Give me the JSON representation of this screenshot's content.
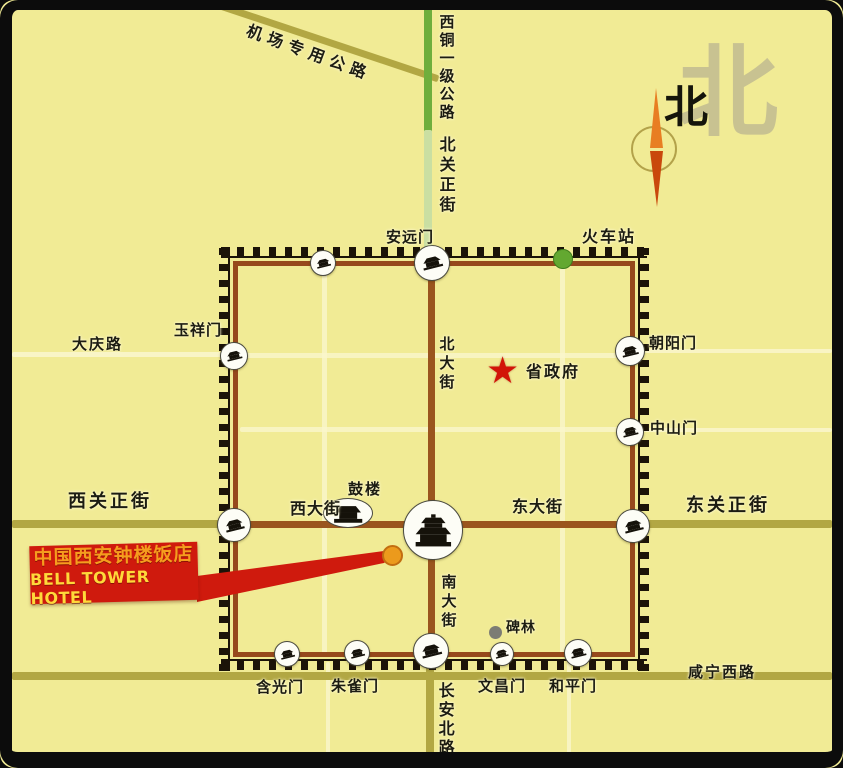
{
  "title": "Bell Tower Hotel Xi'an location map",
  "hotel": {
    "line1": "中国西安钟楼饭店",
    "line2": "BELL TOWER HOTEL"
  },
  "colors": {
    "background": "#f1eb95",
    "frame": "#0c0c0c",
    "wall": "#96491c",
    "teeth": "#1b1308",
    "street_brown": "#9a551e",
    "road_olive": "#b2a743",
    "road_white": "#faf6cc",
    "highway_green": "#6fae3c",
    "highway_pale": "#cadfa2",
    "banner_red": "#cf1a0d",
    "star_red": "#d21408",
    "station_green": "#63a830",
    "beilin_gray": "#7c7c74",
    "hotel_orange": "#ec9a1c",
    "compass_big": "#c8c291",
    "needle_orange": "#e87e22",
    "needle_dark": "#c9480c"
  },
  "compass": {
    "big": "北",
    "small": "北"
  },
  "labels": [
    {
      "name": "airport-road-label",
      "text": "机场专用公路",
      "x": 250,
      "y": 22,
      "size": 16,
      "spacing": 6,
      "rotate": 20,
      "mode": "h"
    },
    {
      "name": "xitong-highway-label",
      "text": "西铜一级公路",
      "x": 438,
      "y": 14,
      "size": 15,
      "spacing": 3,
      "mode": "v"
    },
    {
      "name": "beiguan-street-label",
      "text": "北关正街",
      "x": 437,
      "y": 136,
      "size": 16,
      "spacing": 4,
      "mode": "v"
    },
    {
      "name": "north-big-label",
      "text": "北",
      "x": 678,
      "y": 38,
      "size": 100,
      "spacing": 0,
      "mode": "h",
      "color": "#c8c291"
    },
    {
      "name": "north-small-label",
      "text": "北",
      "x": 664,
      "y": 84,
      "size": 44,
      "spacing": 0,
      "mode": "h",
      "color": "#15150b"
    },
    {
      "name": "station-label",
      "text": "火车站",
      "x": 582,
      "y": 228,
      "size": 16,
      "spacing": 2,
      "mode": "h"
    },
    {
      "name": "anyuanmen-label",
      "text": "安远门",
      "x": 386,
      "y": 229,
      "size": 15,
      "spacing": 1,
      "mode": "h"
    },
    {
      "name": "daqing-road-label",
      "text": "大庆路",
      "x": 72,
      "y": 336,
      "size": 15,
      "spacing": 2,
      "mode": "h"
    },
    {
      "name": "yuxiangmen-label",
      "text": "玉祥门",
      "x": 174,
      "y": 322,
      "size": 15,
      "spacing": 1,
      "mode": "h"
    },
    {
      "name": "chaoyangmen-label",
      "text": "朝阳门",
      "x": 649,
      "y": 335,
      "size": 15,
      "spacing": 1,
      "mode": "h"
    },
    {
      "name": "zhongshanmen-label",
      "text": "中山门",
      "x": 650,
      "y": 420,
      "size": 15,
      "spacing": 1,
      "mode": "h"
    },
    {
      "name": "beidajie-label",
      "text": "北大街",
      "x": 438,
      "y": 336,
      "size": 15,
      "spacing": 4,
      "mode": "v"
    },
    {
      "name": "gov-label",
      "text": "省政府",
      "x": 526,
      "y": 363,
      "size": 16,
      "spacing": 2,
      "mode": "h"
    },
    {
      "name": "xiguan-street-label",
      "text": "西关正街",
      "x": 68,
      "y": 492,
      "size": 18,
      "spacing": 3,
      "mode": "h"
    },
    {
      "name": "dongguan-street-label",
      "text": "东关正街",
      "x": 686,
      "y": 496,
      "size": 18,
      "spacing": 3,
      "mode": "h"
    },
    {
      "name": "gulou-label",
      "text": "鼓楼",
      "x": 348,
      "y": 481,
      "size": 15,
      "spacing": 2,
      "mode": "h"
    },
    {
      "name": "xidajie-label",
      "text": "西大街",
      "x": 290,
      "y": 500,
      "size": 16,
      "spacing": 1,
      "mode": "h"
    },
    {
      "name": "dongdajie-label",
      "text": "东大街",
      "x": 512,
      "y": 498,
      "size": 16,
      "spacing": 1,
      "mode": "h"
    },
    {
      "name": "nandajie-label",
      "text": "南大街",
      "x": 440,
      "y": 574,
      "size": 15,
      "spacing": 4,
      "mode": "v"
    },
    {
      "name": "beilin-label",
      "text": "碑林",
      "x": 506,
      "y": 621,
      "size": 14,
      "spacing": 1,
      "mode": "h"
    },
    {
      "name": "hanguangmen-label",
      "text": "含光门",
      "x": 256,
      "y": 679,
      "size": 15,
      "spacing": 1,
      "mode": "h"
    },
    {
      "name": "zhuquemen-label",
      "text": "朱雀门",
      "x": 331,
      "y": 678,
      "size": 15,
      "spacing": 1,
      "mode": "h"
    },
    {
      "name": "wenchangmen-label",
      "text": "文昌门",
      "x": 478,
      "y": 678,
      "size": 15,
      "spacing": 1,
      "mode": "h"
    },
    {
      "name": "hepingmen-label",
      "text": "和平门",
      "x": 549,
      "y": 678,
      "size": 15,
      "spacing": 1,
      "mode": "h"
    },
    {
      "name": "xianning-road-label",
      "text": "咸宁西路",
      "x": 688,
      "y": 664,
      "size": 15,
      "spacing": 2,
      "mode": "h"
    },
    {
      "name": "changan-road-label",
      "text": "长安北路",
      "x": 436,
      "y": 682,
      "size": 16,
      "spacing": 3,
      "mode": "v"
    }
  ],
  "roads": [
    {
      "name": "daqing-road",
      "x": 12,
      "y": 352,
      "w": 218,
      "h": 5,
      "color": "#faf6cc",
      "opacity": 0.9
    },
    {
      "name": "chaoyang-east-road",
      "x": 641,
      "y": 349,
      "w": 191,
      "h": 4,
      "color": "#faf6cc",
      "opacity": 0.85
    },
    {
      "name": "zhongshan-east-road",
      "x": 641,
      "y": 428,
      "w": 191,
      "h": 4,
      "color": "#faf6cc",
      "opacity": 0.85
    },
    {
      "name": "inner-street-v-west",
      "x": 322,
      "y": 267,
      "w": 5,
      "h": 390,
      "color": "#faf6cc",
      "opacity": 0.8
    },
    {
      "name": "inner-street-v-east",
      "x": 560,
      "y": 267,
      "w": 5,
      "h": 390,
      "color": "#faf6cc",
      "opacity": 0.8
    },
    {
      "name": "inner-street-h-north",
      "x": 240,
      "y": 353,
      "w": 392,
      "h": 5,
      "color": "#faf6cc",
      "opacity": 0.8
    },
    {
      "name": "inner-street-h-mid",
      "x": 240,
      "y": 427,
      "w": 392,
      "h": 5,
      "color": "#faf6cc",
      "opacity": 0.8
    },
    {
      "name": "south-street-v-west",
      "x": 326,
      "y": 662,
      "w": 4,
      "h": 92,
      "color": "#faf6cc",
      "opacity": 0.8
    },
    {
      "name": "south-street-v-east",
      "x": 567,
      "y": 662,
      "w": 4,
      "h": 92,
      "color": "#faf6cc",
      "opacity": 0.8
    },
    {
      "name": "xiguan-road",
      "x": 12,
      "y": 520,
      "w": 214,
      "h": 8,
      "color": "#b2a743"
    },
    {
      "name": "dongguan-road",
      "x": 644,
      "y": 520,
      "w": 188,
      "h": 8,
      "color": "#b2a743"
    },
    {
      "name": "south-ring-road",
      "x": 12,
      "y": 672,
      "w": 820,
      "h": 8,
      "color": "#b2a743"
    },
    {
      "name": "changan-north-road",
      "x": 426,
      "y": 661,
      "w": 8,
      "h": 93,
      "color": "#b2a743"
    },
    {
      "name": "airport-expressway",
      "x": 207,
      "y": -2,
      "w": 244,
      "h": 7,
      "color": "#b2a743",
      "rotate": 18.5
    },
    {
      "name": "xitong-highway-green",
      "x": 424,
      "y": 8,
      "w": 8,
      "h": 124,
      "color": "#6fae3c"
    },
    {
      "name": "xitong-highway-pale",
      "x": 424,
      "y": 130,
      "w": 8,
      "h": 130,
      "color": "#cadfa2"
    },
    {
      "name": "bei-nan-dajie-street",
      "x": 428,
      "y": 266,
      "w": 7,
      "h": 391,
      "color": "#9a551e",
      "z": 14
    },
    {
      "name": "xi-dong-dajie-street",
      "x": 238,
      "y": 521,
      "w": 394,
      "h": 7,
      "color": "#9a551e",
      "z": 14
    }
  ],
  "wall": {
    "x": 233,
    "y": 261,
    "w": 402,
    "h": 396
  },
  "gates": [
    {
      "name": "gate-north-minor",
      "x": 322,
      "y": 262,
      "r": 12
    },
    {
      "name": "gate-anyuanmen",
      "x": 431,
      "y": 262,
      "r": 17
    },
    {
      "name": "gate-yuxiangmen",
      "x": 233,
      "y": 355,
      "r": 13
    },
    {
      "name": "gate-west",
      "x": 233,
      "y": 524,
      "r": 16
    },
    {
      "name": "gate-chaoyangmen",
      "x": 629,
      "y": 350,
      "r": 14
    },
    {
      "name": "gate-zhongshanmen",
      "x": 629,
      "y": 431,
      "r": 13
    },
    {
      "name": "gate-east",
      "x": 632,
      "y": 525,
      "r": 16
    },
    {
      "name": "gate-hanguangmen",
      "x": 286,
      "y": 653,
      "r": 12
    },
    {
      "name": "gate-zhuquemen",
      "x": 356,
      "y": 652,
      "r": 12
    },
    {
      "name": "gate-south",
      "x": 430,
      "y": 650,
      "r": 17
    },
    {
      "name": "gate-wenchangmen",
      "x": 501,
      "y": 653,
      "r": 11
    },
    {
      "name": "gate-hepingmen",
      "x": 577,
      "y": 652,
      "r": 13
    }
  ],
  "landmarks": {
    "bell_tower": {
      "x": 432,
      "y": 529,
      "r": 29
    },
    "drum_tower": {
      "x": 347,
      "y": 512,
      "rx": 24,
      "ry": 14
    },
    "gov_star": {
      "x": 504,
      "y": 371
    },
    "station_dot": {
      "x": 562,
      "y": 258,
      "r": 9
    },
    "beilin_dot": {
      "x": 495,
      "y": 632,
      "r": 6.5
    },
    "hotel_dot": {
      "x": 392,
      "y": 555,
      "r": 10.5
    }
  }
}
